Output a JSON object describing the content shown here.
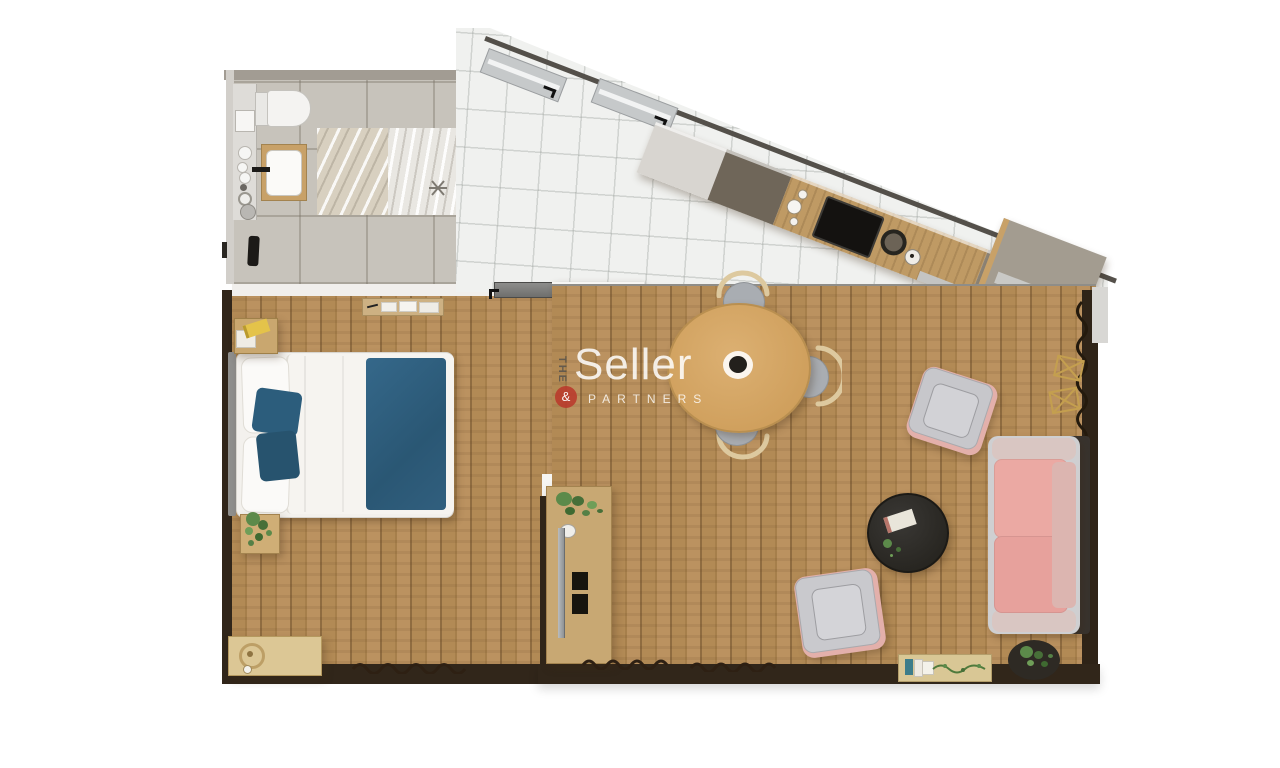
{
  "watermark": {
    "the": "THE",
    "name": "Seller",
    "amp": "&",
    "partners": "PARTNERS",
    "accent_color": "#b9392b",
    "text_color": "#ffffff"
  },
  "palette": {
    "wood_floor": "#b28a55",
    "wall_dark": "#31261a",
    "bathroom_tile": "#c7c3bb",
    "kitchen_tile": "#f0f1ef",
    "counter_wood": "#bf9a64",
    "counter_taupe": "#8e8577",
    "cooktop_black": "#141210",
    "dining_table_tan": "#d5a865",
    "chair_gray": "#a9adb2",
    "chair_back_wood": "#ddc99f",
    "sofa_pink": "#eba9a3",
    "armchair_gray": "#c7c7cb",
    "blanket_blue": "#2e6080",
    "plant_green": "#5c8a4a",
    "gold_decor": "#c49f4f"
  },
  "rooms": [
    {
      "name": "bathroom",
      "objects": [
        "toilet",
        "vanity-strip",
        "washbasin",
        "marble-shower-tile",
        "floor-drain",
        "dark-mat"
      ]
    },
    {
      "name": "kitchen-hall",
      "objects": [
        "window-1",
        "window-2",
        "kitchen-counter",
        "cooktop",
        "sink",
        "corner-cabinet",
        "door-threshold"
      ]
    },
    {
      "name": "bedroom",
      "objects": [
        "double-bed",
        "blue-blanket",
        "pillows",
        "nightstand",
        "plant-stand",
        "wall-shelf",
        "dresser",
        "rug-fringe"
      ]
    },
    {
      "name": "living-room",
      "objects": [
        "dining-table",
        "dining-chairs",
        "armchair-top",
        "armchair-bottom",
        "pink-sofa",
        "coffee-table",
        "tv-console",
        "bookshelf",
        "plant-pot",
        "gold-wire-decor"
      ]
    }
  ]
}
